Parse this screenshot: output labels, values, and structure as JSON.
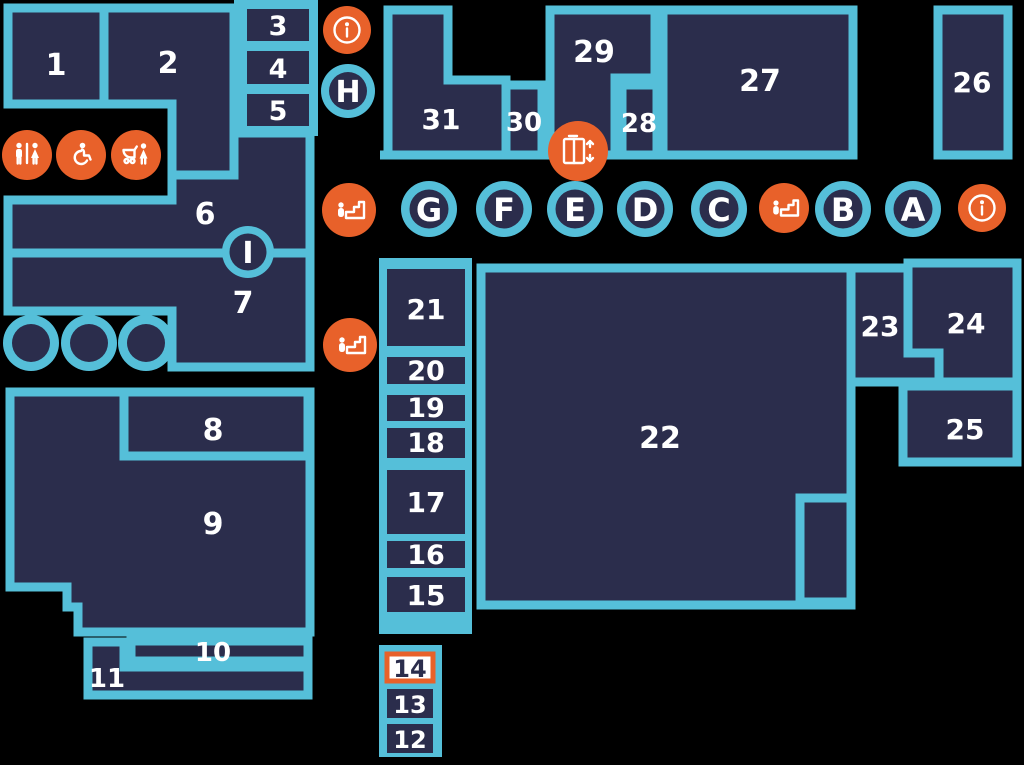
{
  "colors": {
    "background": "#000000",
    "room_fill": "#2B2D4C",
    "outline": "#55BFD9",
    "accent": "#E8612A",
    "label_text": "#FFFFFF",
    "highlight_fill": "#FFFFFF",
    "highlight_border": "#E8612A",
    "highlight_text": "#2B2D4C"
  },
  "rooms": [
    {
      "label": "1"
    },
    {
      "label": "2"
    },
    {
      "label": "3"
    },
    {
      "label": "4"
    },
    {
      "label": "5"
    },
    {
      "label": "6"
    },
    {
      "label": "7"
    },
    {
      "label": "8"
    },
    {
      "label": "9"
    },
    {
      "label": "10"
    },
    {
      "label": "11"
    },
    {
      "label": "12"
    },
    {
      "label": "13"
    },
    {
      "label": "14"
    },
    {
      "label": "15"
    },
    {
      "label": "16"
    },
    {
      "label": "17"
    },
    {
      "label": "18"
    },
    {
      "label": "19"
    },
    {
      "label": "20"
    },
    {
      "label": "21"
    },
    {
      "label": "22"
    },
    {
      "label": "23"
    },
    {
      "label": "24"
    },
    {
      "label": "25"
    },
    {
      "label": "26"
    },
    {
      "label": "27"
    },
    {
      "label": "28"
    },
    {
      "label": "29"
    },
    {
      "label": "30"
    },
    {
      "label": "31"
    }
  ],
  "zones": [
    {
      "label": "G"
    },
    {
      "label": "F"
    },
    {
      "label": "E"
    },
    {
      "label": "D"
    },
    {
      "label": "C"
    },
    {
      "label": "B"
    },
    {
      "label": "A"
    },
    {
      "label": "H"
    },
    {
      "label": "I"
    }
  ],
  "amenities": [
    {
      "type": "restroom"
    },
    {
      "type": "accessible-restroom"
    },
    {
      "type": "baby-care"
    },
    {
      "type": "information"
    },
    {
      "type": "escalator"
    },
    {
      "type": "escalator"
    },
    {
      "type": "elevator"
    },
    {
      "type": "escalator"
    },
    {
      "type": "information"
    }
  ],
  "highlighted_room": "14"
}
